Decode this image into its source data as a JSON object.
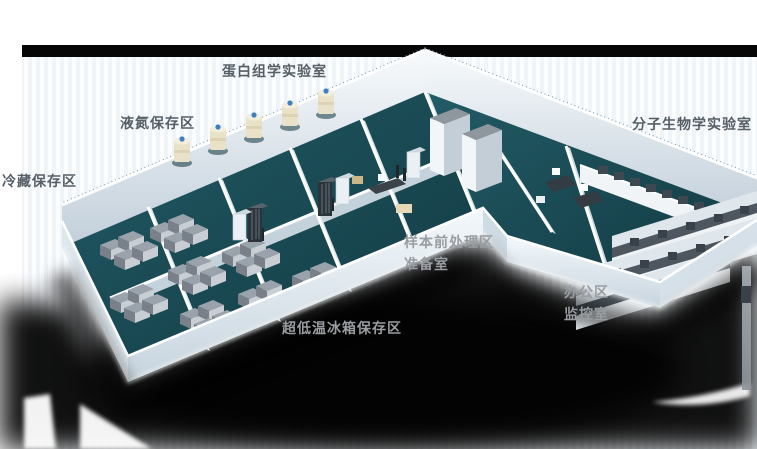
{
  "meta": {
    "description": "3D isometric render of an L-shaped biobank laboratory floor plan with labeled functional areas",
    "canvas": {
      "width": 757,
      "height": 449
    }
  },
  "area_labels": [
    {
      "id": "proteomics-lab",
      "text": "蛋白组学实验室",
      "tone": "dark"
    },
    {
      "id": "liquid-nitrogen-storage",
      "text": "液氮保存区",
      "tone": "dark"
    },
    {
      "id": "cold-storage",
      "text": "冷藏保存区",
      "tone": "dark"
    },
    {
      "id": "molecular-biology-lab",
      "text": "分子生物学实验室",
      "tone": "dark"
    },
    {
      "id": "sample-pretreatment",
      "text": "样本前处理区",
      "tone": "light"
    },
    {
      "id": "prep-room",
      "text": "准备室",
      "tone": "light"
    },
    {
      "id": "office-area",
      "text": "办公区",
      "tone": "light"
    },
    {
      "id": "monitoring-room",
      "text": "监控室",
      "tone": "light"
    },
    {
      "id": "ult-freezer-storage",
      "text": "超低温冰箱保存区",
      "tone": "light"
    }
  ],
  "colors": {
    "background": "#ffffff",
    "backdrop_stripe_a": "#eff4f9",
    "backdrop_stripe_b": "#fafcfe",
    "top_bar": "#060606",
    "floor_teal": "#1b4e58",
    "wall_white": "#eef4f8",
    "wall_shade": "#c9d5de",
    "label_dark": "#575f66",
    "label_light": "#989da2",
    "ln2_tank_body": "#e9e1c8",
    "ln2_tank_cap": "#3f7fc1",
    "freezer_gray": "#9aa3ab",
    "bench_top": "#4e575f",
    "shadow": "#000000"
  },
  "equipment_legend": [
    "liquid-nitrogen-tanks",
    "ult-chest-freezers",
    "tall-storage-cabinets",
    "office-desks-with-monitors",
    "lab-benches-with-reagent-shelves"
  ]
}
